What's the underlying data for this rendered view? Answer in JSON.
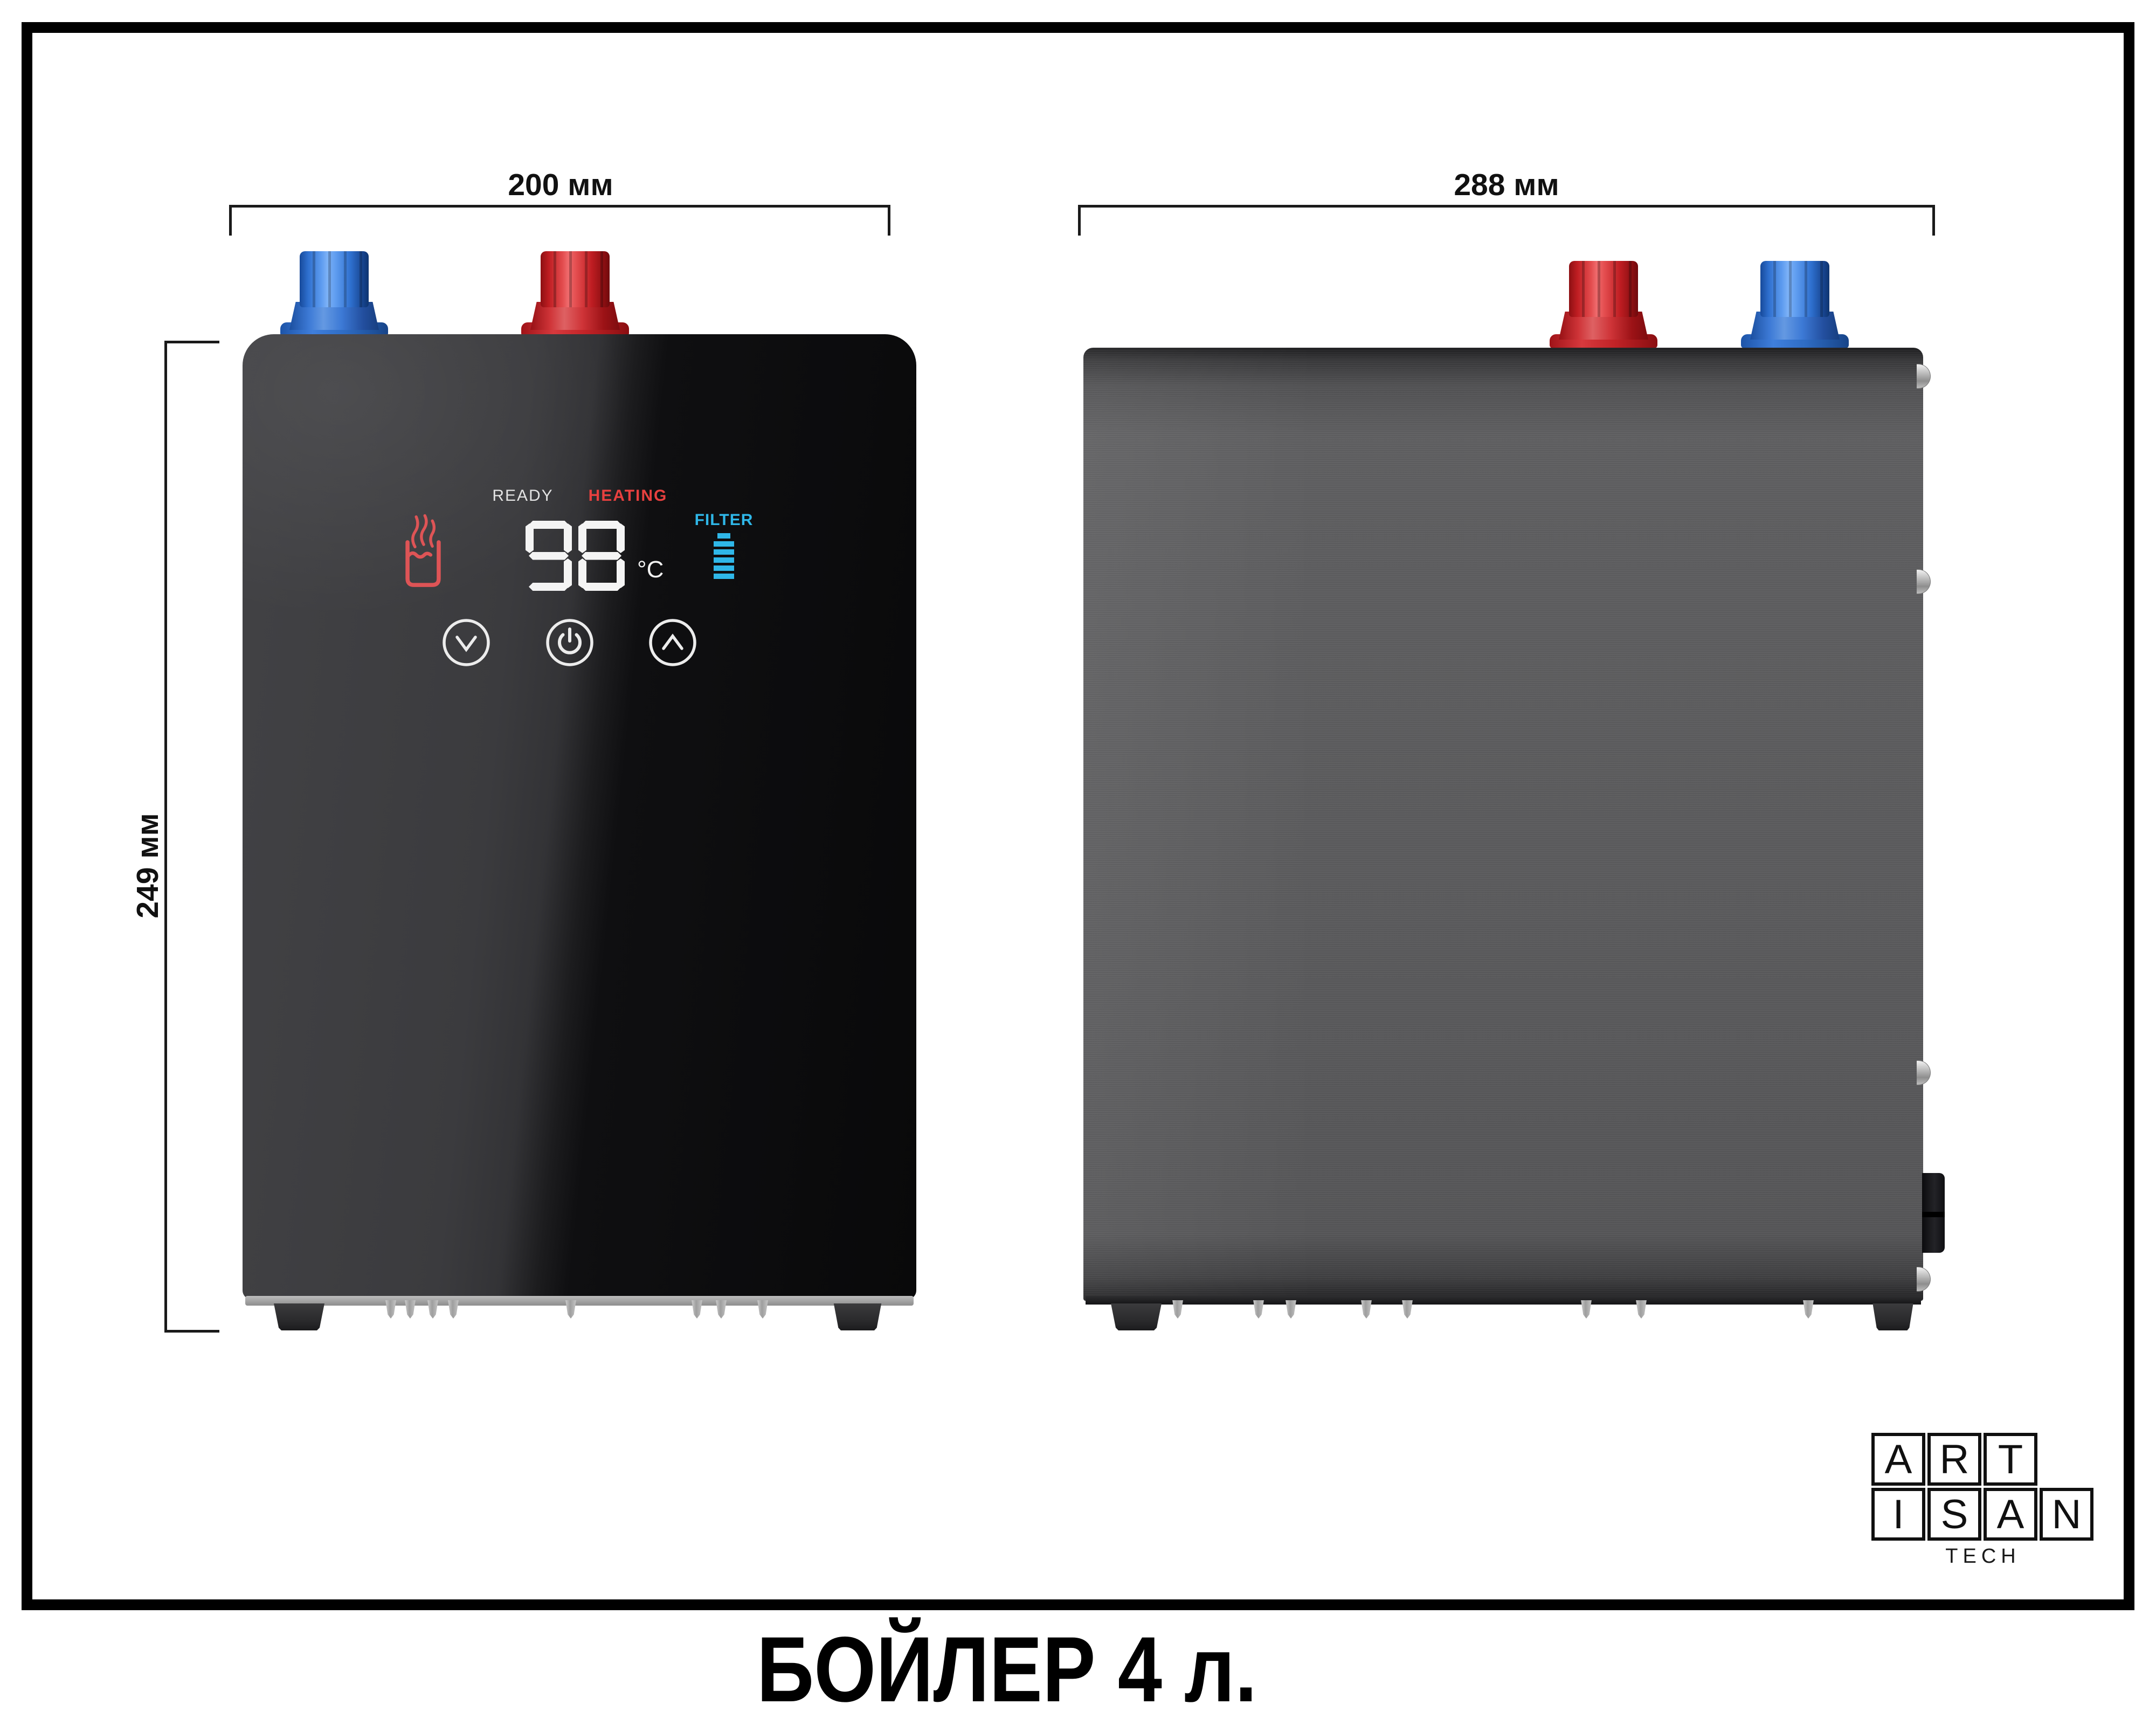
{
  "caption": {
    "text": "БОЙЛЕР 4 л."
  },
  "views": {
    "front": {
      "width_label": "200 мм",
      "height_label": "249 мм"
    },
    "side": {
      "width_label": "288 мм"
    }
  },
  "display": {
    "ready": "READY",
    "heating": "HEATING",
    "filter": "FILTER",
    "temperature": "98",
    "unit": "°C",
    "filter_level": 6
  },
  "logo": {
    "row1": [
      "A",
      "R",
      "T"
    ],
    "row2": [
      "I",
      "S",
      "A",
      "N"
    ],
    "tagline": "TECH"
  },
  "colors": {
    "ready_text": "#e3e3e3",
    "heating_text": "#e8403f",
    "filter_text": "#2fb7e8",
    "cold_inlet": "#2e6fce",
    "hot_outlet": "#c21e24",
    "segment_display": "#f4f4f4"
  }
}
